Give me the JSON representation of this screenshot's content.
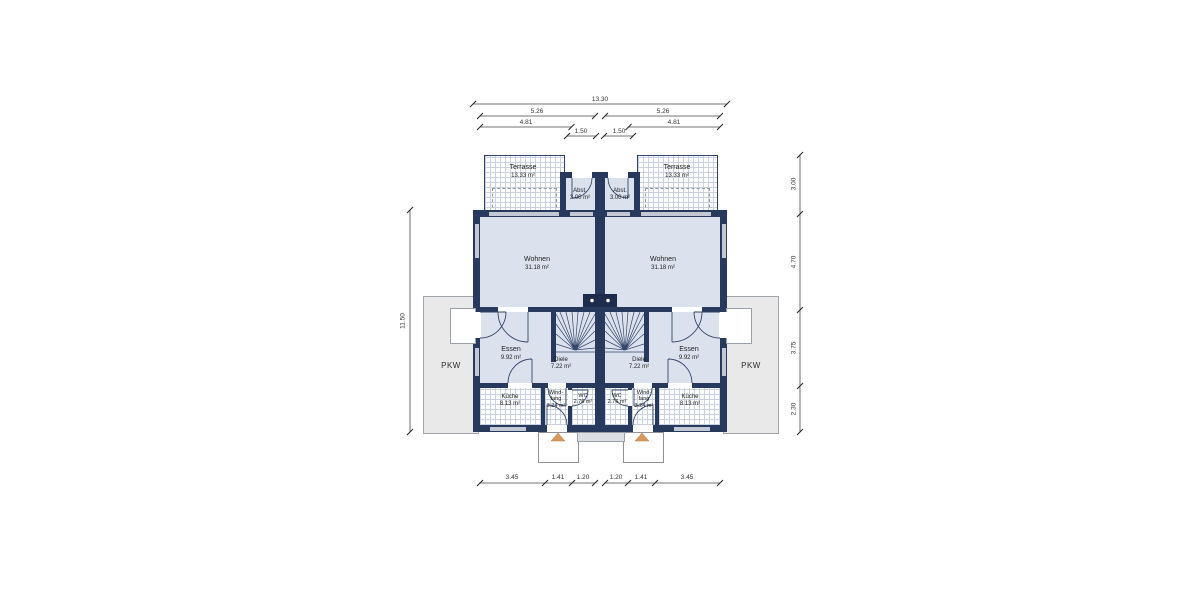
{
  "rooms": {
    "terrasse": {
      "name": "Terrasse",
      "area": "13.33 m²"
    },
    "abst": {
      "name": "Abst.",
      "area": "3.00 m²"
    },
    "wohnen": {
      "name": "Wohnen",
      "area": "31.18 m²"
    },
    "essen": {
      "name": "Essen",
      "area": "9.92 m²"
    },
    "diele": {
      "name": "Diele",
      "area": "7.22 m²"
    },
    "kueche": {
      "name": "Küche",
      "area": "8.13 m²"
    },
    "windfang": {
      "line1": "Wind-",
      "line2": "fang",
      "area": "3.24 m²"
    },
    "wc": {
      "name": "WC",
      "area": "2.76 m²"
    },
    "pkw": {
      "name": "PKW"
    }
  },
  "dimensions": {
    "top": {
      "total": "13.30",
      "half_left": "5.26",
      "half_right": "5.26",
      "inner_left": "4.81",
      "inner_right": "4.81",
      "mid_left": "1.50",
      "mid_right": "1.50"
    },
    "left": {
      "total": "11.50"
    },
    "right": {
      "terrace": "3.00",
      "wohnen": "4.70",
      "mid": "3.75",
      "kueche": "2.30"
    },
    "bottom": {
      "s1": "3.45",
      "s2": "1.41",
      "s3": "1.20",
      "s4": "1.20",
      "s5": "1.41",
      "s6": "3.45"
    }
  },
  "colors": {
    "wall": "#27395c",
    "room_fill": "#dce2ed",
    "hatch_line": "#c9d1de",
    "carport_fill": "#e9e9e9",
    "entry_arrow": "#d49a62",
    "dimension_text": "#333333"
  }
}
